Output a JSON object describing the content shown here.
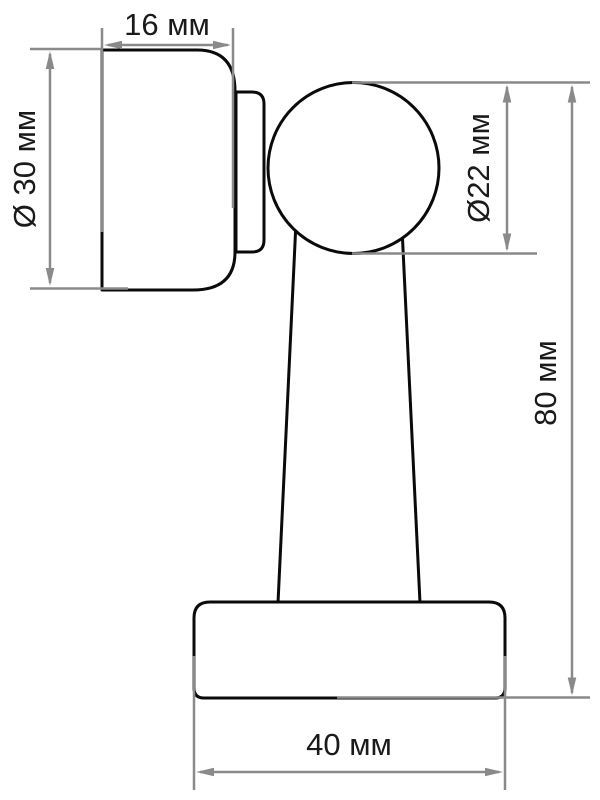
{
  "drawing": {
    "units": "мм",
    "dimensions": {
      "cap_width": {
        "label": "16 мм",
        "value_mm": 16
      },
      "cap_diameter": {
        "label": "Ø 30 мм",
        "value_mm": 30
      },
      "ball_diameter": {
        "label": "Ø22 мм",
        "value_mm": 22
      },
      "total_height": {
        "label": "80 мм",
        "value_mm": 80
      },
      "base_width": {
        "label": "40 мм",
        "value_mm": 40
      }
    },
    "colors": {
      "outline": "#0a0a0a",
      "dimension": "#8a8a8a",
      "text": "#1a1a1a",
      "background": "#ffffff"
    }
  }
}
